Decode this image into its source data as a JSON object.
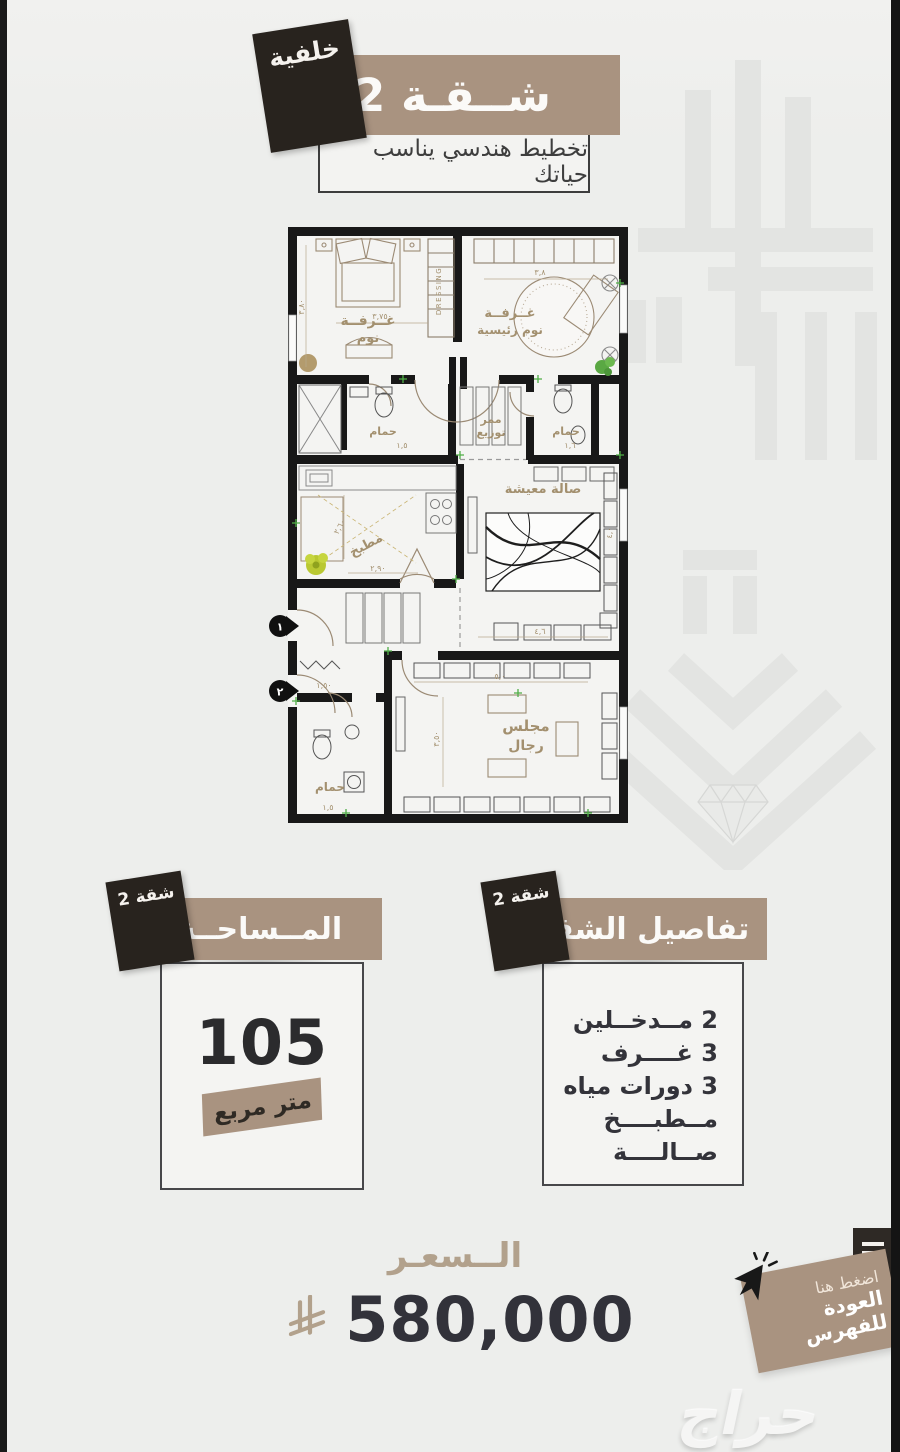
{
  "colors": {
    "accent": "#a99380",
    "dark": "#28231e",
    "page_bg": "#edeeec",
    "text_dark": "#33333a",
    "plan_line": "#9b8a74",
    "green": "#4fae46"
  },
  "header": {
    "badge": "خلفية",
    "title": "شــقـة 2",
    "subtitle": "تخطيط هندسي يناسب حياتك"
  },
  "floor_plan": {
    "rooms": {
      "bedroom_l1": "غــرفــة",
      "bedroom_l2": "نوم",
      "master_l1": "غــرفــة",
      "master_l2": "نوم رئيسية",
      "bath": "حمام",
      "corridor_l1": "ممر",
      "corridor_l2": "توزيع",
      "kitchen": "مطبخ",
      "living": "صالة معيشة",
      "majlis_l1": "مجلس",
      "majlis_l2": "رجال"
    },
    "dressing": "DRESSING",
    "entrance1": "١",
    "entrance2": "٢",
    "dims": {
      "bed_w": "٣,٧٥",
      "bed_h": "٣,٨٠",
      "master_w": "٣,٨",
      "bath1": "١,٥",
      "bath2": "١,٦",
      "kitchen_h": "٢,٦٠",
      "kitchen_w": "٢,٩٠",
      "living_w": "٤,٦",
      "living_h": "٤,٠",
      "majlis_h": "٣,٥٠",
      "majlis_w": "٥,٠",
      "entry": "١,٥٠",
      "bath3": "١,٥"
    }
  },
  "area": {
    "badge": "شقة 2",
    "title": "المــساحــة",
    "value": "105",
    "unit": "متر مربع"
  },
  "details": {
    "badge": "شقة 2",
    "title": "تفاصيل الشقة",
    "items": [
      "2 مــدخــلين",
      "3 غــــرف",
      "3 دورات مياه",
      "مــطبــــخ",
      "صــالــــة"
    ]
  },
  "price": {
    "label": "الــسعـر",
    "value": "580,000",
    "currency_icon": "saudi-riyal-symbol"
  },
  "ribbon": {
    "hint": "اضغط هنا",
    "label": "العودة للفهرس"
  },
  "watermark": "حراج"
}
